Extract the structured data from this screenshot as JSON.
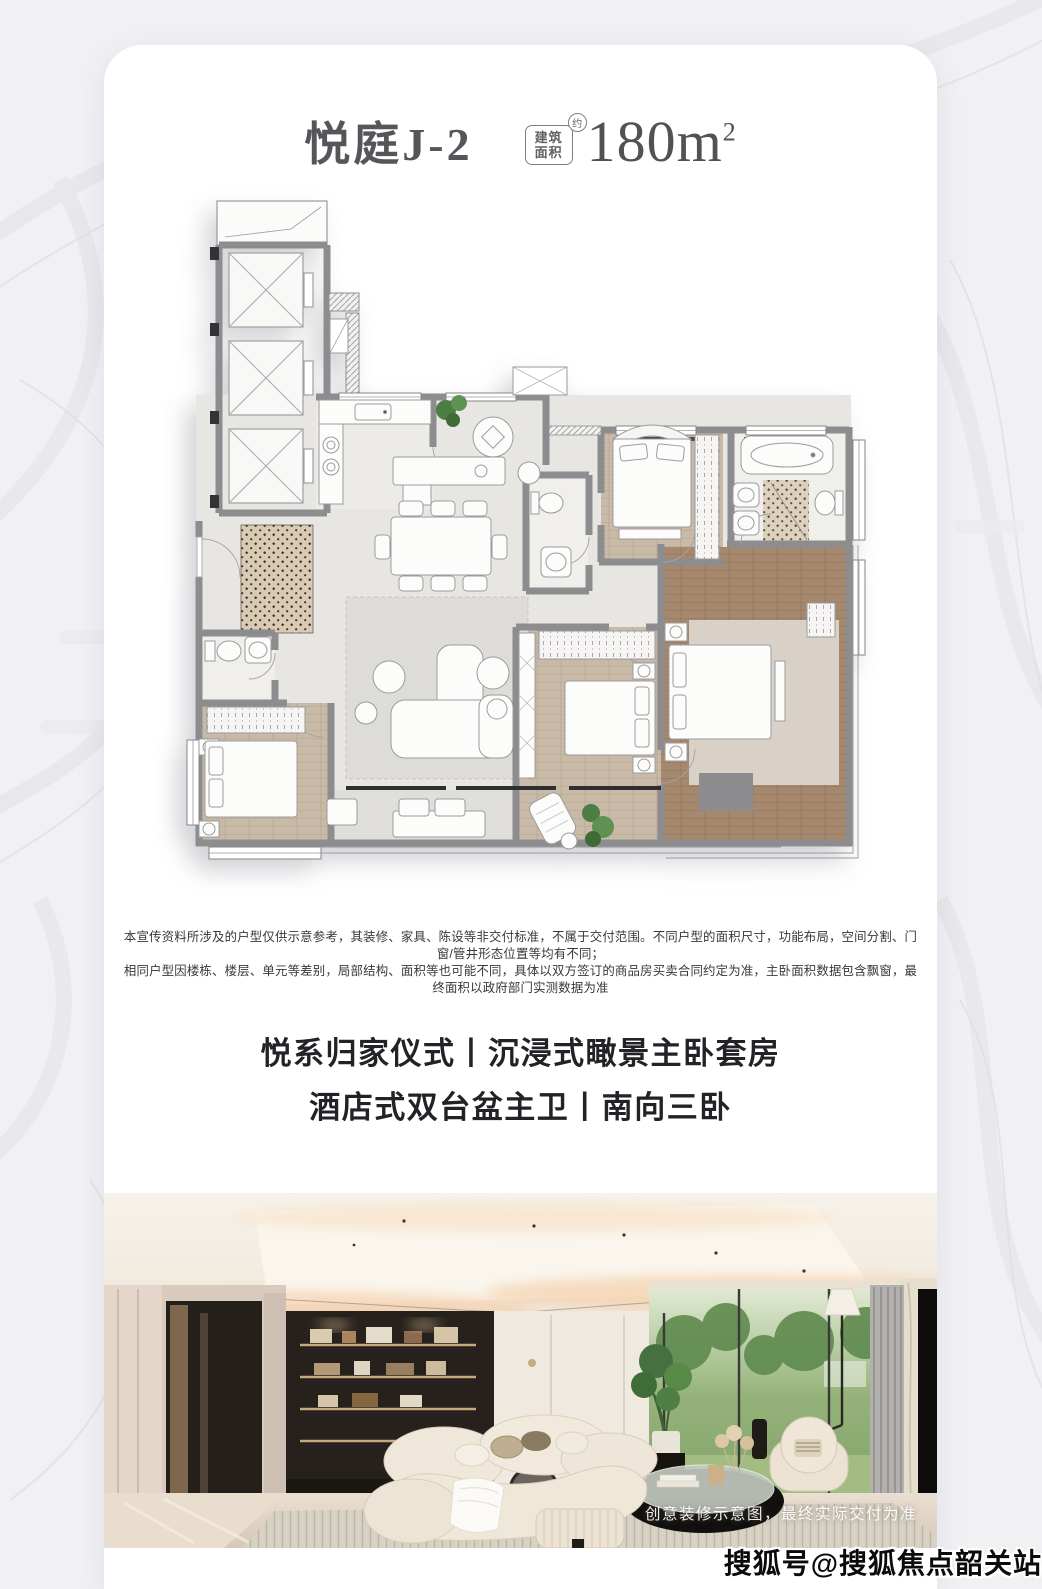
{
  "card": {
    "header": {
      "unit_name": "悦庭J-2",
      "area_badge": {
        "line1": "建筑",
        "line2": "面积",
        "approx": "约"
      },
      "area_value": "180m",
      "area_sup": "2"
    },
    "disclaimer": [
      "本宣传资料所涉及的户型仅供示意参考，其装修、家具、陈设等非交付标准，不属于交付范围。不同户型的面积尺寸，功能布局，空间分割、门窗/管井形态位置等均有不同；",
      "相同户型因楼栋、楼层、单元等差别，局部结构、面积等也可能不同，具体以双方签订的商品房买卖合同约定为准，主卧面积数据包含飘窗，最终面积以政府部门实测数据为准"
    ],
    "headline": [
      "悦系归家仪式丨沉浸式瞰景主卧套房",
      "酒店式双台盆主卫丨南向三卧"
    ],
    "photo": {
      "caption": "创意装修示意图，最终实际交付为准"
    }
  },
  "watermark": "搜狐号@搜狐焦点韶关站",
  "colors": {
    "page_bg": "#f1f1f4",
    "card_bg": "#ffffff",
    "title_text": "#55565a",
    "wall_gray": "#8d8d8f",
    "floor_light": "#e8e6e3",
    "wood_floor": "#c8b9a6",
    "master_floor": "#a4876c",
    "plant_green": "#4d7c44",
    "headline_text": "#232327"
  }
}
